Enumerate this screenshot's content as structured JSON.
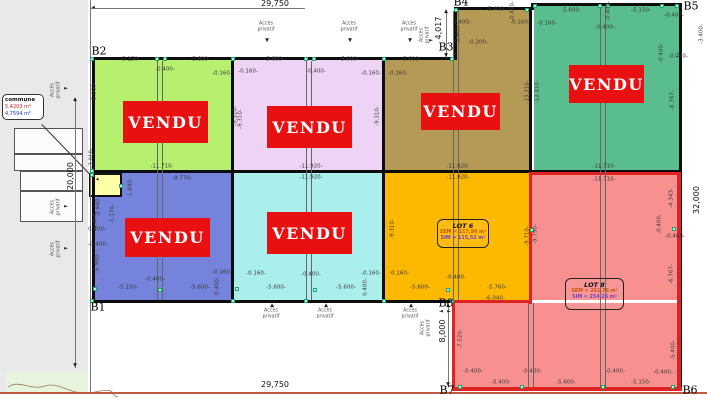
{
  "plan_title": "plan de division - lotissement",
  "vendu_text": "VENDU",
  "commune": {
    "name": "commune",
    "area_red": "5.4203 m²",
    "area_blue": "4,7594 m²"
  },
  "colors": {
    "parcel_green": "#b7ef6f",
    "parcel_plum": "#eed4f4",
    "parcel_tan": "#b59a55",
    "parcel_darkgreen": "#5abd8d",
    "parcel_blue": "#7583dc",
    "parcel_cyan": "#abefec",
    "parcel_orange": "#fdb800",
    "parcel_red": "#f89090",
    "parcel_yellow": "#ffffaa",
    "vendu_red": "#e81010",
    "lot8_outline": "#e02222"
  },
  "sketch_rects": [
    {
      "x": 14,
      "y": 128,
      "w": 69,
      "h": 26
    },
    {
      "x": 14,
      "y": 154,
      "w": 69,
      "h": 17
    },
    {
      "x": 20,
      "y": 171,
      "w": 63,
      "h": 20
    },
    {
      "x": 20,
      "y": 191,
      "w": 63,
      "h": 31
    }
  ],
  "parcels": [
    {
      "name": "parcel-green",
      "x": 95,
      "y": 60,
      "w": 136,
      "h": 110,
      "color": "#b7ef6f"
    },
    {
      "name": "parcel-plum",
      "x": 234,
      "y": 60,
      "w": 148,
      "h": 110,
      "color": "#eed4f4"
    },
    {
      "name": "parcel-tan-main",
      "x": 385,
      "y": 60,
      "w": 144,
      "h": 110,
      "color": "#b59a55"
    },
    {
      "name": "parcel-tan-ext",
      "x": 457,
      "y": 10,
      "w": 72,
      "h": 52,
      "color": "#b59a55"
    },
    {
      "name": "parcel-darkgreen",
      "x": 534,
      "y": 6,
      "w": 145,
      "h": 164,
      "color": "#5abd8d"
    },
    {
      "name": "parcel-blue",
      "x": 95,
      "y": 173,
      "w": 136,
      "h": 127,
      "color": "#7583dc"
    },
    {
      "name": "parcel-cyan",
      "x": 234,
      "y": 173,
      "w": 148,
      "h": 127,
      "color": "#abefec"
    },
    {
      "name": "parcel-orange",
      "x": 385,
      "y": 173,
      "w": 144,
      "h": 127,
      "color": "#fdb800"
    },
    {
      "name": "parcel-red-upper",
      "x": 532,
      "y": 175,
      "w": 145,
      "h": 125,
      "color": "#f89090"
    },
    {
      "name": "parcel-red-lower",
      "x": 455,
      "y": 303,
      "w": 222,
      "h": 84,
      "color": "#f89090"
    },
    {
      "name": "parcel-yellow-notch",
      "x": 89,
      "y": 173,
      "w": 33,
      "h": 24,
      "color": "#ffffaa",
      "cls": "bordered"
    }
  ],
  "black_lines": [
    {
      "x": 92,
      "y": 57,
      "w": 364,
      "h": 3
    },
    {
      "x": 454,
      "y": 9,
      "w": 3,
      "h": 51
    },
    {
      "x": 454,
      "y": 7,
      "w": 79,
      "h": 3
    },
    {
      "x": 531,
      "y": 4,
      "w": 3,
      "h": 6
    },
    {
      "x": 531,
      "y": 3,
      "w": 150,
      "h": 3
    },
    {
      "x": 679,
      "y": 3,
      "w": 3,
      "h": 388
    },
    {
      "x": 452,
      "y": 388,
      "w": 230,
      "h": 3
    },
    {
      "x": 452,
      "y": 302,
      "w": 3,
      "h": 89
    },
    {
      "x": 92,
      "y": 300,
      "w": 362,
      "h": 3
    },
    {
      "x": 92,
      "y": 57,
      "w": 3,
      "h": 246
    },
    {
      "x": 92,
      "y": 170,
      "w": 589,
      "h": 3
    },
    {
      "x": 231,
      "y": 59,
      "w": 3,
      "h": 243
    },
    {
      "x": 382,
      "y": 59,
      "w": 3,
      "h": 243
    },
    {
      "x": 529,
      "y": 9,
      "w": 3,
      "h": 163
    }
  ],
  "red_lines": [
    {
      "x": 529,
      "y": 172,
      "w": 152,
      "h": 3
    },
    {
      "x": 529,
      "y": 172,
      "w": 3,
      "h": 132
    },
    {
      "x": 452,
      "y": 300,
      "w": 80,
      "h": 3
    },
    {
      "x": 452,
      "y": 300,
      "w": 3,
      "h": 91
    },
    {
      "x": 452,
      "y": 387,
      "w": 230,
      "h": 4
    },
    {
      "x": 677,
      "y": 172,
      "w": 4,
      "h": 219
    }
  ],
  "center_lines": [
    {
      "x": 157,
      "y": 61,
      "h": 239
    },
    {
      "x": 306,
      "y": 61,
      "h": 239
    },
    {
      "x": 453,
      "y": 11,
      "h": 289
    },
    {
      "x": 600,
      "y": 6,
      "h": 381
    },
    {
      "x": 528,
      "y": 303,
      "h": 84
    }
  ],
  "thin_lines": [
    {
      "x": 90,
      "y": 0,
      "w": 1,
      "h": 393
    },
    {
      "x": 75,
      "y": 98,
      "w": 1,
      "h": 270
    },
    {
      "x": 90,
      "y": 8,
      "w": 215,
      "h": 1
    },
    {
      "x": 446,
      "y": 10,
      "w": 1,
      "h": 48
    },
    {
      "x": 448,
      "y": 304,
      "w": 1,
      "h": 83
    },
    {
      "x": 0,
      "y": 392,
      "w": 707,
      "h": 2,
      "color": "#c05a40"
    }
  ],
  "ticks": [
    {
      "x": 92,
      "y": 59
    },
    {
      "x": 157,
      "y": 59
    },
    {
      "x": 165,
      "y": 59
    },
    {
      "x": 233,
      "y": 59
    },
    {
      "x": 306,
      "y": 59
    },
    {
      "x": 314,
      "y": 59
    },
    {
      "x": 384,
      "y": 59
    },
    {
      "x": 452,
      "y": 59
    },
    {
      "x": 456,
      "y": 10
    },
    {
      "x": 527,
      "y": 10
    },
    {
      "x": 535,
      "y": 6
    },
    {
      "x": 600,
      "y": 6
    },
    {
      "x": 608,
      "y": 6
    },
    {
      "x": 662,
      "y": 6
    },
    {
      "x": 677,
      "y": 6
    },
    {
      "x": 677,
      "y": 55
    },
    {
      "x": 674,
      "y": 229
    },
    {
      "x": 92,
      "y": 171
    },
    {
      "x": 92,
      "y": 175
    },
    {
      "x": 95,
      "y": 289
    },
    {
      "x": 160,
      "y": 290
    },
    {
      "x": 237,
      "y": 289
    },
    {
      "x": 315,
      "y": 290
    },
    {
      "x": 448,
      "y": 290
    },
    {
      "x": 92,
      "y": 301
    },
    {
      "x": 233,
      "y": 301
    },
    {
      "x": 306,
      "y": 301
    },
    {
      "x": 384,
      "y": 301
    },
    {
      "x": 452,
      "y": 301
    },
    {
      "x": 460,
      "y": 387
    },
    {
      "x": 522,
      "y": 387
    },
    {
      "x": 603,
      "y": 387
    },
    {
      "x": 673,
      "y": 387
    },
    {
      "x": 532,
      "y": 230
    },
    {
      "x": 121,
      "y": 186
    }
  ],
  "vendu_boxes": [
    {
      "t": "VENDU",
      "x": 123,
      "y": 101,
      "w": 85,
      "h": 42
    },
    {
      "t": "VENDU",
      "x": 267,
      "y": 106,
      "w": 85,
      "h": 42
    },
    {
      "t": "VENDU",
      "x": 421,
      "y": 93,
      "w": 79,
      "h": 37
    },
    {
      "t": "VENDU",
      "x": 569,
      "y": 65,
      "w": 75,
      "h": 38
    },
    {
      "t": "VENDU",
      "x": 125,
      "y": 218,
      "w": 85,
      "h": 39
    },
    {
      "t": "VENDU",
      "x": 267,
      "y": 212,
      "w": 85,
      "h": 42
    }
  ],
  "lots": [
    {
      "title": "LOT 6",
      "sem": "SEM = 117,96 m²",
      "sim": "SIM = 115,52 m²",
      "x": 437,
      "y": 219,
      "w": 52,
      "h": 29
    },
    {
      "title": "LOT 8",
      "sem": "SEM = 261,76 m²",
      "sim": "SIM = 254,26 m²",
      "x": 565,
      "y": 278,
      "w": 59,
      "h": 32
    }
  ],
  "corners": [
    {
      "t": "B1",
      "x": 98,
      "y": 307
    },
    {
      "t": "B2",
      "x": 99,
      "y": 51
    },
    {
      "t": "B3",
      "x": 446,
      "y": 47
    },
    {
      "t": "B4",
      "x": 461,
      "y": 2
    },
    {
      "t": "B5",
      "x": 691,
      "y": 6
    },
    {
      "t": "B6",
      "x": 690,
      "y": 390
    },
    {
      "t": "B7",
      "x": 447,
      "y": 390
    },
    {
      "t": "B8",
      "x": 446,
      "y": 303
    }
  ],
  "big_dims": [
    {
      "t": "29,750",
      "x": 275,
      "y": 4,
      "r": 0
    },
    {
      "t": "29,750",
      "x": 275,
      "y": 385,
      "r": 0
    },
    {
      "t": "32,000",
      "x": 697,
      "y": 200,
      "r": 1
    },
    {
      "t": "20,000",
      "x": 71,
      "y": 176,
      "r": 1
    },
    {
      "t": "4,017",
      "x": 439,
      "y": 28,
      "r": 1
    },
    {
      "t": "8,000",
      "x": 443,
      "y": 331,
      "r": 1
    }
  ],
  "dims": [
    {
      "t": "-5.150-",
      "x": 130,
      "y": 60,
      "r": 0
    },
    {
      "t": "-0.400-",
      "x": 165,
      "y": 70,
      "r": 0
    },
    {
      "t": "-5.600-",
      "x": 200,
      "y": 60,
      "r": 0
    },
    {
      "t": "-0.160-",
      "x": 222,
      "y": 74,
      "r": 0
    },
    {
      "t": "-5.900-",
      "x": 95,
      "y": 92,
      "r": 1
    },
    {
      "t": "-3.010-",
      "x": 92,
      "y": 158,
      "r": 1
    },
    {
      "t": "-9.310-",
      "x": 236,
      "y": 116,
      "r": 1
    },
    {
      "t": "-11.710-",
      "x": 162,
      "y": 167,
      "r": 0
    },
    {
      "t": "-0.160-",
      "x": 248,
      "y": 72,
      "r": 0
    },
    {
      "t": "-5.600-",
      "x": 274,
      "y": 60,
      "r": 0
    },
    {
      "t": "-0.400-",
      "x": 316,
      "y": 72,
      "r": 0
    },
    {
      "t": "-5.600-",
      "x": 349,
      "y": 60,
      "r": 0
    },
    {
      "t": "-0.160-",
      "x": 371,
      "y": 74,
      "r": 0
    },
    {
      "t": "-9.310-",
      "x": 241,
      "y": 119,
      "r": 1
    },
    {
      "t": "-9.310-",
      "x": 378,
      "y": 116,
      "r": 1
    },
    {
      "t": "-11.920-",
      "x": 311,
      "y": 167,
      "r": 0
    },
    {
      "t": "0.400-",
      "x": 462,
      "y": 23,
      "r": 0
    },
    {
      "t": "-5.400-",
      "x": 496,
      "y": 10,
      "r": 0
    },
    {
      "t": "-0.160-",
      "x": 520,
      "y": 23,
      "r": 0
    },
    {
      "t": "-0.400-",
      "x": 513,
      "y": 11,
      "r": 1
    },
    {
      "t": "-3.600-",
      "x": 459,
      "y": 34,
      "r": 1
    },
    {
      "t": "-5.600-",
      "x": 411,
      "y": 60,
      "r": 0
    },
    {
      "t": "-0.160-",
      "x": 398,
      "y": 74,
      "r": 0
    },
    {
      "t": "-0.200-",
      "x": 478,
      "y": 43,
      "r": 0
    },
    {
      "t": "-13.310-",
      "x": 528,
      "y": 92,
      "r": 1
    },
    {
      "t": "-11.920-",
      "x": 458,
      "y": 167,
      "r": 0
    },
    {
      "t": "-5.600-",
      "x": 571,
      "y": 11,
      "r": 0
    },
    {
      "t": "-0.160-",
      "x": 547,
      "y": 24,
      "r": 0
    },
    {
      "t": "-0.400-",
      "x": 605,
      "y": 28,
      "r": 0
    },
    {
      "t": "-5.150-",
      "x": 641,
      "y": 11,
      "r": 0
    },
    {
      "t": "-0.400-",
      "x": 674,
      "y": 16,
      "r": 0
    },
    {
      "t": "-0.400-",
      "x": 609,
      "y": 11,
      "r": 1
    },
    {
      "t": "-3.400-",
      "x": 702,
      "y": 34,
      "r": 1
    },
    {
      "t": "-0.400-",
      "x": 662,
      "y": 53,
      "r": 1
    },
    {
      "t": "-0.400-",
      "x": 678,
      "y": 57,
      "r": 0
    },
    {
      "t": "-13.310-",
      "x": 538,
      "y": 92,
      "r": 1
    },
    {
      "t": "-6.767-",
      "x": 673,
      "y": 100,
      "r": 1
    },
    {
      "t": "-11.710-",
      "x": 604,
      "y": 167,
      "r": 0
    },
    {
      "t": "-8.770-",
      "x": 182,
      "y": 179,
      "r": 0
    },
    {
      "t": "-1.840-",
      "x": 131,
      "y": 188,
      "r": 1
    },
    {
      "t": "-2.940-",
      "x": 99,
      "y": 207,
      "r": 1
    },
    {
      "t": "-1.170-",
      "x": 113,
      "y": 214,
      "r": 1
    },
    {
      "t": "-0.400-",
      "x": 96,
      "y": 221,
      "r": 1
    },
    {
      "t": "0.400-",
      "x": 97,
      "y": 230,
      "r": 0
    },
    {
      "t": "-0.400-",
      "x": 98,
      "y": 245,
      "r": 0
    },
    {
      "t": "-5.900-",
      "x": 98,
      "y": 263,
      "r": 1
    },
    {
      "t": "-5.150-",
      "x": 128,
      "y": 288,
      "r": 0
    },
    {
      "t": "-0.400-",
      "x": 155,
      "y": 280,
      "r": 0
    },
    {
      "t": "-5.600-",
      "x": 200,
      "y": 288,
      "r": 0
    },
    {
      "t": "-0.160-",
      "x": 222,
      "y": 273,
      "r": 0
    },
    {
      "t": "0.400-",
      "x": 218,
      "y": 286,
      "r": 1
    },
    {
      "t": "-11.920-",
      "x": 311,
      "y": 178,
      "r": 0
    },
    {
      "t": "-0.160-",
      "x": 256,
      "y": 274,
      "r": 0
    },
    {
      "t": "-5.600-",
      "x": 276,
      "y": 288,
      "r": 0
    },
    {
      "t": "-0.400-",
      "x": 311,
      "y": 275,
      "r": 0
    },
    {
      "t": "-5.600-",
      "x": 346,
      "y": 288,
      "r": 0
    },
    {
      "t": "-0.160-",
      "x": 371,
      "y": 274,
      "r": 0
    },
    {
      "t": "0.400-",
      "x": 366,
      "y": 287,
      "r": 1
    },
    {
      "t": "-11.920-",
      "x": 458,
      "y": 178,
      "r": 0
    },
    {
      "t": "-9.310-",
      "x": 393,
      "y": 229,
      "r": 1
    },
    {
      "t": "-9.710-",
      "x": 528,
      "y": 236,
      "r": 1
    },
    {
      "t": "-0.160-",
      "x": 399,
      "y": 274,
      "r": 0
    },
    {
      "t": "-5.600-",
      "x": 420,
      "y": 288,
      "r": 0
    },
    {
      "t": "-0.400-",
      "x": 456,
      "y": 278,
      "r": 0
    },
    {
      "t": "-5.760-",
      "x": 497,
      "y": 288,
      "r": 0
    },
    {
      "t": "-11.710-",
      "x": 604,
      "y": 180,
      "r": 0
    },
    {
      "t": "-9.790-",
      "x": 536,
      "y": 234,
      "r": 1
    },
    {
      "t": "-4.343-",
      "x": 672,
      "y": 198,
      "r": 1
    },
    {
      "t": "-0.400-",
      "x": 660,
      "y": 224,
      "r": 1
    },
    {
      "t": "-0.400-",
      "x": 675,
      "y": 237,
      "r": 0
    },
    {
      "t": "-6.767-",
      "x": 672,
      "y": 274,
      "r": 1
    },
    {
      "t": "-6.040-",
      "x": 495,
      "y": 299,
      "r": 0
    },
    {
      "t": "-7.520-",
      "x": 461,
      "y": 339,
      "r": 1
    },
    {
      "t": "-5.400-",
      "x": 674,
      "y": 350,
      "r": 1
    },
    {
      "t": "-0.400-",
      "x": 473,
      "y": 372,
      "r": 0
    },
    {
      "t": "-5.400-",
      "x": 501,
      "y": 383,
      "r": 0
    },
    {
      "t": "-0.400-",
      "x": 532,
      "y": 372,
      "r": 0
    },
    {
      "t": "-5.600-",
      "x": 566,
      "y": 383,
      "r": 0
    },
    {
      "t": "-0.400-",
      "x": 615,
      "y": 372,
      "r": 0
    },
    {
      "t": "-5.150-",
      "x": 641,
      "y": 383,
      "r": 0
    },
    {
      "t": "-0.400-",
      "x": 663,
      "y": 373,
      "r": 0
    }
  ],
  "access": [
    {
      "l1": "Accès",
      "l2": "privatif",
      "x": 56,
      "y": 90,
      "r": 1
    },
    {
      "l1": "Accès",
      "l2": "privatif",
      "x": 266,
      "y": 27,
      "r": 0
    },
    {
      "l1": "Accès",
      "l2": "privatif",
      "x": 349,
      "y": 27,
      "r": 0
    },
    {
      "l1": "Accès",
      "l2": "privatif",
      "x": 409,
      "y": 27,
      "r": 0
    },
    {
      "l1": "Accès",
      "l2": "privatif",
      "x": 425,
      "y": 35,
      "r": 1
    },
    {
      "l1": "Accès",
      "l2": "privatif",
      "x": 56,
      "y": 207,
      "r": 1
    },
    {
      "l1": "Accès",
      "l2": "privatif",
      "x": 56,
      "y": 249,
      "r": 1
    },
    {
      "l1": "Accès",
      "l2": "privatif",
      "x": 271,
      "y": 314,
      "r": 0
    },
    {
      "l1": "Accès",
      "l2": "privatif",
      "x": 325,
      "y": 314,
      "r": 0
    },
    {
      "l1": "Accès",
      "l2": "privatif",
      "x": 410,
      "y": 314,
      "r": 0
    },
    {
      "l1": "Accès",
      "l2": "privatif",
      "x": 426,
      "y": 328,
      "r": 1
    }
  ],
  "arrows": [
    {
      "g": "▼",
      "x": 267,
      "y": 41
    },
    {
      "g": "▼",
      "x": 350,
      "y": 41
    },
    {
      "g": "▼",
      "x": 410,
      "y": 41
    },
    {
      "g": "►",
      "x": 431,
      "y": 41
    },
    {
      "g": "►",
      "x": 66,
      "y": 89
    },
    {
      "g": "►",
      "x": 66,
      "y": 207
    },
    {
      "g": "►",
      "x": 66,
      "y": 249
    },
    {
      "g": "▲",
      "x": 272,
      "y": 306
    },
    {
      "g": "▲",
      "x": 326,
      "y": 306
    },
    {
      "g": "▲",
      "x": 411,
      "y": 306
    },
    {
      "g": "◄",
      "x": 441,
      "y": 312
    },
    {
      "g": "►",
      "x": 449,
      "y": 312
    },
    {
      "g": "◄",
      "x": 93,
      "y": 8
    },
    {
      "g": "▲",
      "x": 75,
      "y": 100
    },
    {
      "g": "▼",
      "x": 75,
      "y": 366
    },
    {
      "g": "▲",
      "x": 446,
      "y": 12
    },
    {
      "g": "▼",
      "x": 446,
      "y": 56
    },
    {
      "g": "▲",
      "x": 448,
      "y": 306
    },
    {
      "g": "▼",
      "x": 448,
      "y": 385
    },
    {
      "g": "➤",
      "x": 97,
      "y": 180,
      "deg": 46
    }
  ]
}
